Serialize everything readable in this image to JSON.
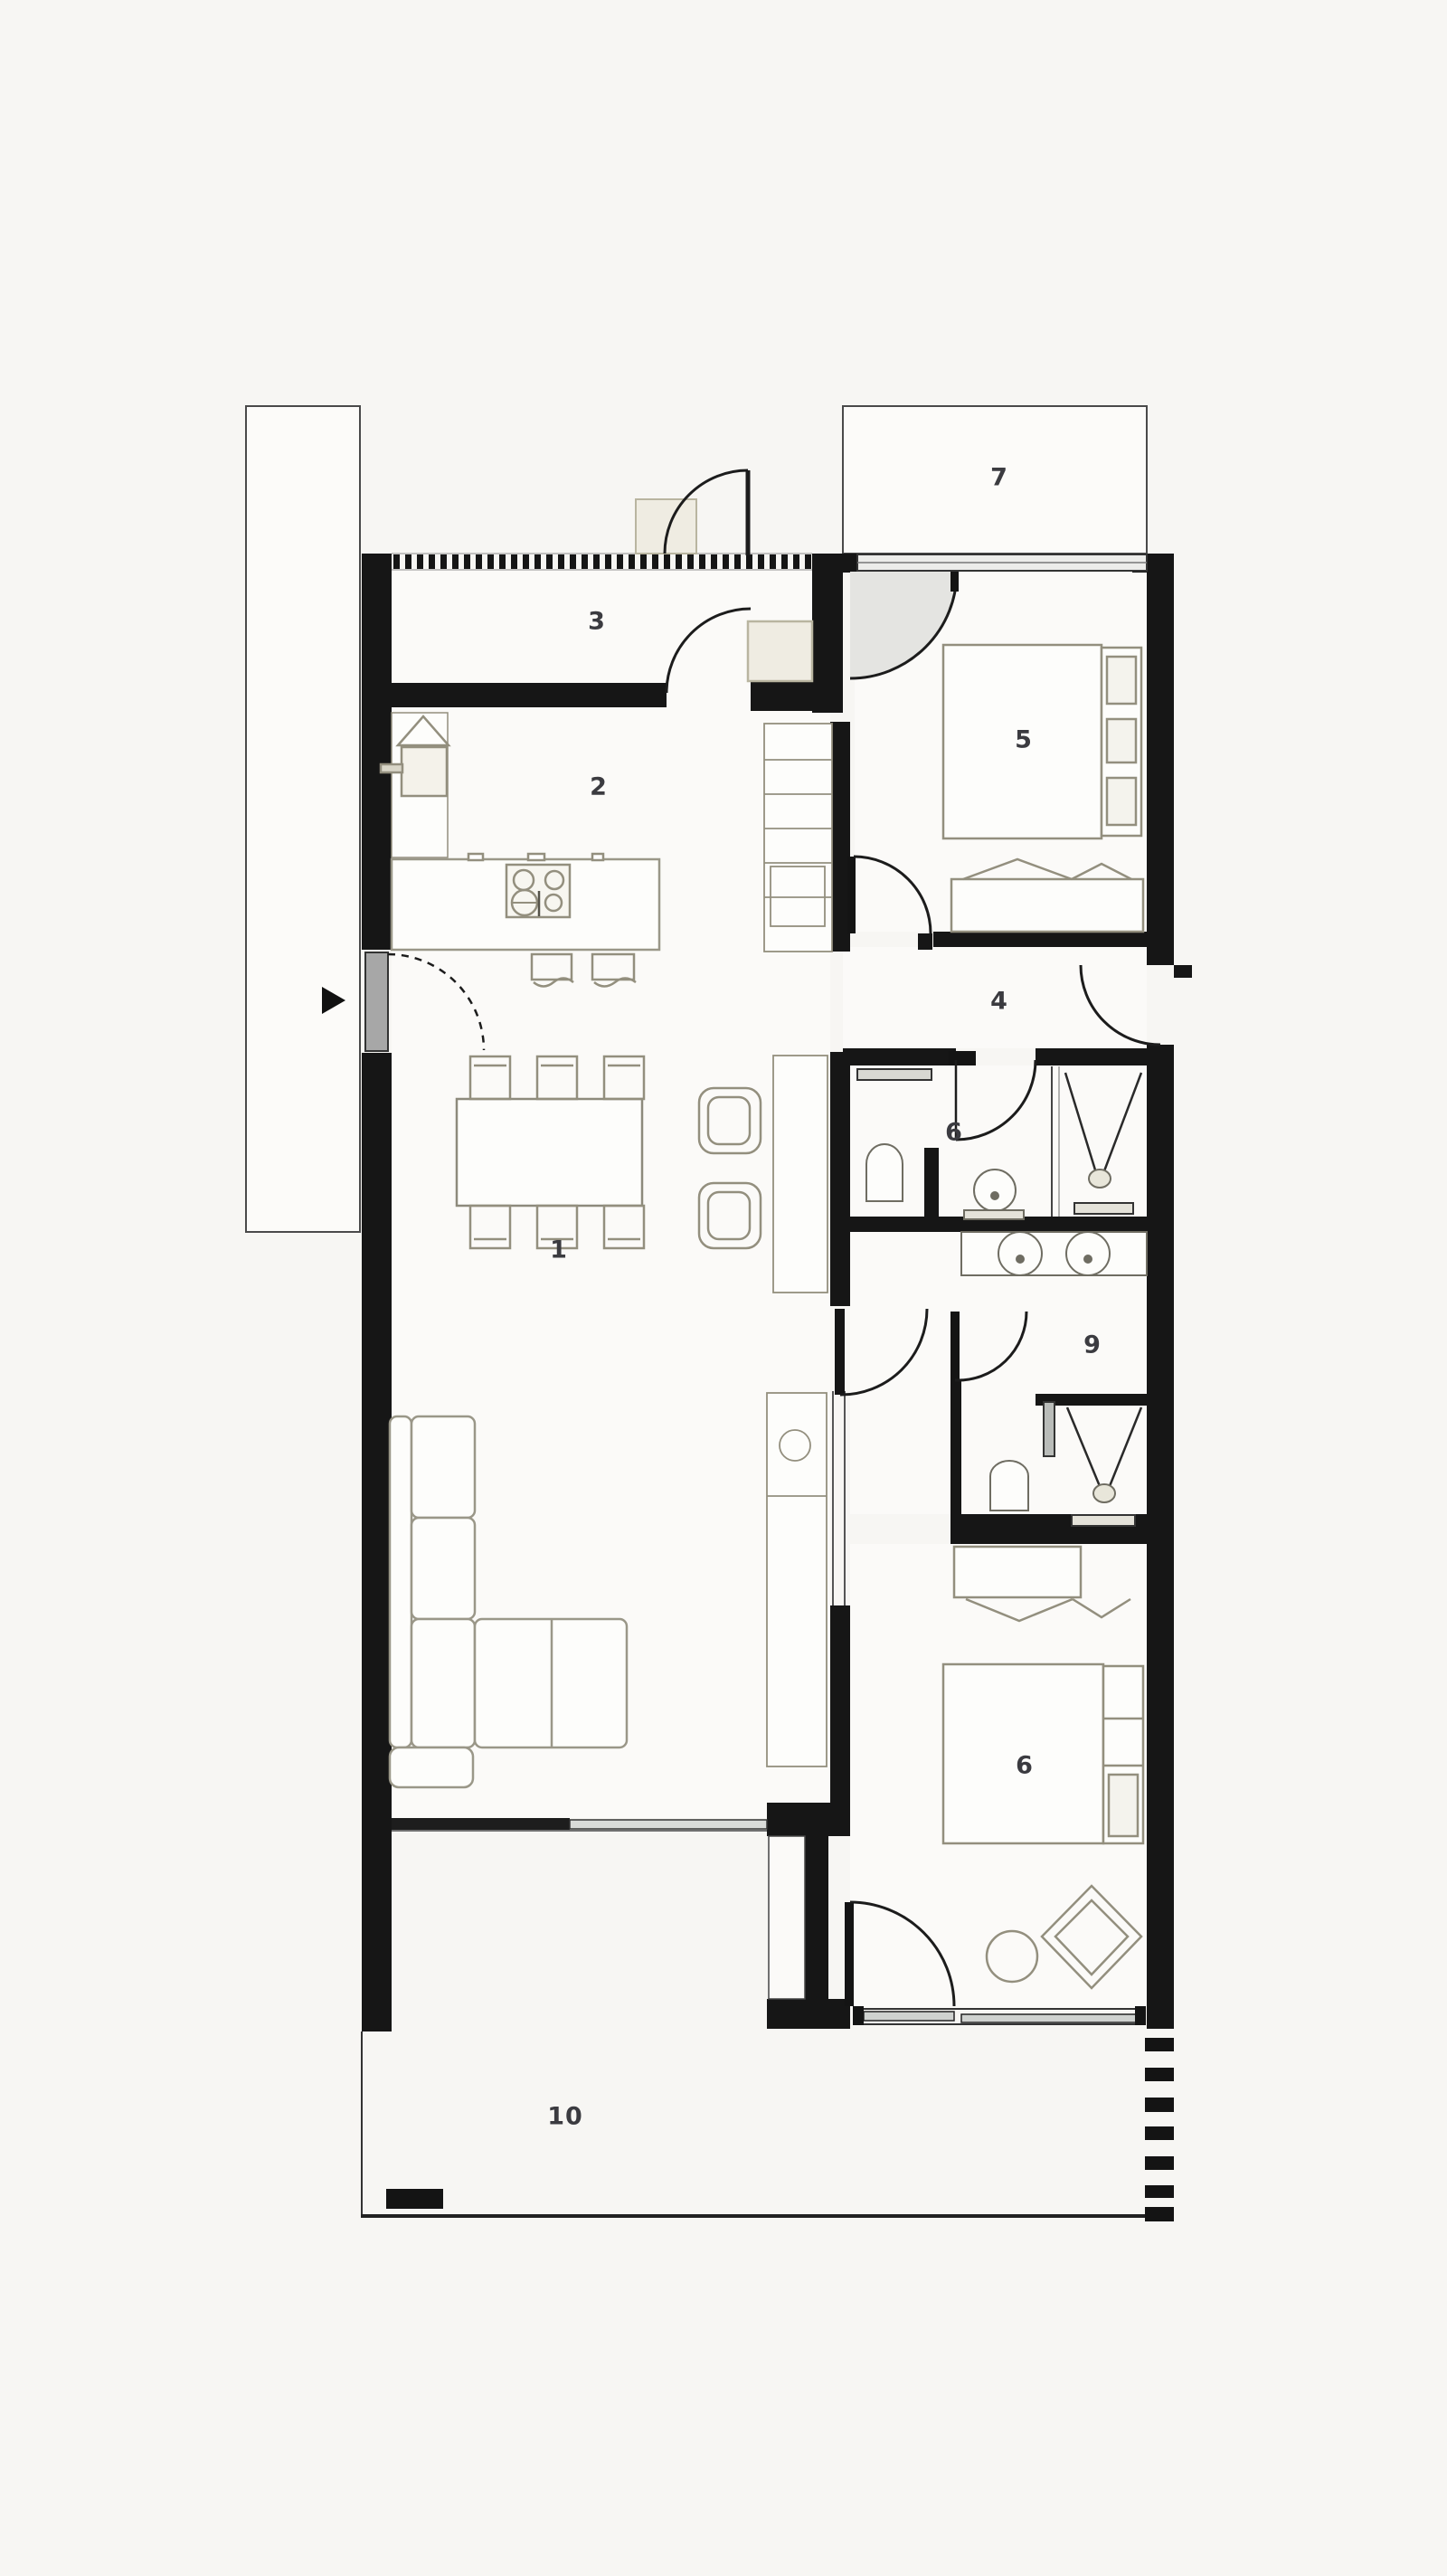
{
  "document": {
    "type": "architectural floor plan, top-down, black and white presentation style"
  },
  "rooms": [
    {
      "key": "living-room",
      "label": "1"
    },
    {
      "key": "kitchen",
      "label": "2"
    },
    {
      "key": "entry-hall",
      "label": "3"
    },
    {
      "key": "hallway",
      "label": "4"
    },
    {
      "key": "bedroom-top",
      "label": "5"
    },
    {
      "key": "bathroom",
      "label": "6"
    },
    {
      "key": "terrace-top",
      "label": "7"
    },
    {
      "key": "bedroom-bottom",
      "label": "6"
    },
    {
      "key": "ensuite-corridor",
      "label": "9"
    },
    {
      "key": "terrace-bottom",
      "label": "10"
    }
  ],
  "colors": {
    "paper": "#f7f6f3",
    "floor": "#fbfaf8",
    "wall": "#161616",
    "furniture_line": "#938f7e",
    "glass_panel": "#c9ccc9",
    "door_panel": "#a7a7a7",
    "label_text": "#3b3b40"
  },
  "icons": [
    {
      "name": "entry-arrow-icon",
      "meaning": "entrance direction marker on west wall"
    }
  ]
}
